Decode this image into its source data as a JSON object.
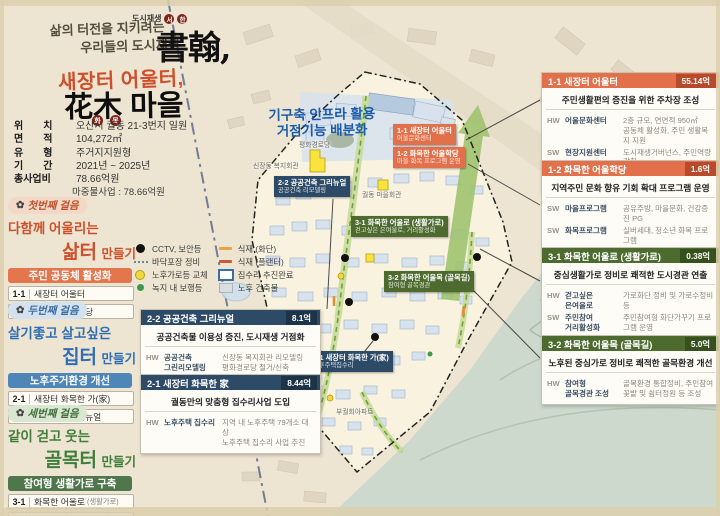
{
  "accents": {
    "orange": "#e2714b",
    "navy": "#2d4a66",
    "green": "#4d6b2f",
    "blue_banner": "#4f86b8",
    "note_blue": "#1b5caa"
  },
  "icons": {
    "flower": "✿"
  },
  "poster": {
    "slogan1": "삶의 터전을 지키려는",
    "slogan2": "우리들의 도시재생",
    "brand_prefix": "도시재생",
    "brand_circle1": "서",
    "brand_circle2": "한",
    "brand_hanja": "書翰,",
    "title_line1": "새장터 어울터,",
    "title_line2": "花木 마을",
    "title_circle1": "화",
    "title_circle2": "목"
  },
  "info": {
    "rows": [
      {
        "label": "위　　치",
        "value": "오산시 궐동 21-3번지 일원"
      },
      {
        "label": "면　　적",
        "value": "104,272㎡"
      },
      {
        "label": "유　　형",
        "value": "주거지지원형"
      },
      {
        "label": "기　　간",
        "value": "2021년 ~ 2025년"
      },
      {
        "label": "총사업비",
        "value": "78.66억원"
      }
    ],
    "sub_value": "마중물사업 : 78.66억원"
  },
  "steps": [
    {
      "badge": "첫번째 걸음",
      "line1": "다함께 어울리는",
      "word": "삶터",
      "suffix": "만들기",
      "banner": "주민 공동체 활성화",
      "items": [
        {
          "no": "1-1",
          "label": "새장터 어울터",
          "note": ""
        },
        {
          "no": "1-2",
          "label": "화목한 어울학당",
          "note": ""
        }
      ]
    },
    {
      "badge": "두번째 걸음",
      "line1": "살기좋고 살고싶은",
      "word": "집터",
      "suffix": "만들기",
      "banner": "노후주거환경 개선",
      "items": [
        {
          "no": "2-1",
          "label": "새장터 화목한 가(家)",
          "note": ""
        },
        {
          "no": "2-2",
          "label": "공공건축 그리뉴얼",
          "note": ""
        }
      ]
    },
    {
      "badge": "세번째 걸음",
      "line1": "같이 걷고 웃는",
      "word": "골목터",
      "suffix": "만들기",
      "banner": "참여형 생활가로 구축",
      "items": [
        {
          "no": "3-1",
          "label": "화목한 어울로",
          "note": "(생활가로)"
        },
        {
          "no": "3-2",
          "label": "화목한 어울목",
          "note": "(골목길)"
        }
      ]
    }
  ],
  "legend": {
    "col1": [
      {
        "icon": "cctv-icon",
        "label": "CCTV, 보안등"
      },
      {
        "icon": "paving-dots-icon",
        "label": "바닥포장 정비"
      },
      {
        "icon": "streetlamp-dot-icon",
        "label": "노후가로등 교체"
      },
      {
        "icon": "walklight-dot-icon",
        "label": "녹지 내 보행등"
      }
    ],
    "col2": [
      {
        "icon": "planting-flowerbed-line-icon",
        "label": "식재 (화단)"
      },
      {
        "icon": "planting-planter-line-icon",
        "label": "식재 (플랜터)"
      },
      {
        "icon": "repair-done-rect-icon",
        "label": "집수리 추진완료"
      },
      {
        "icon": "old-building-rect-icon",
        "label": "노후 건축물"
      }
    ]
  },
  "map": {
    "note": "기구축 인프라 활용\n거점기능 배분화",
    "landmark1": "평화경로당",
    "landmark2": "신장동 복지회관",
    "landmark3": "궐동 마을회관",
    "landmark4": "부궐회아파트",
    "tags": [
      {
        "title": "1-1 새장터 어울터",
        "sub": "어울문화센터"
      },
      {
        "title": "1-2 화목한 어울학당",
        "sub": "마을·화목 프로그램 운영"
      },
      {
        "title": "2-2 공공건축 그리뉴얼",
        "sub": "공공건축 리모델링"
      },
      {
        "title": "2-1 새장터 화목한 가(家)",
        "sub": "노후주택집수리"
      },
      {
        "title": "3-1 화목한 어울로 (생활가로)",
        "sub": "걷고싶은 은여울로, 거리활성화"
      },
      {
        "title": "3-2 화목한 어울목 (골목길)",
        "sub": "참여형 골목경관"
      }
    ]
  },
  "boxes": [
    {
      "title": "1-1 새장터 어울터",
      "budget": "55.14억",
      "subtitle": "주민생활편의 증진을 위한 주차장 조성",
      "rows": [
        {
          "tag": "HW",
          "name": "어울문화센터",
          "desc": "2층 규모, 연면적 950㎡\n공동체 활성화, 주민 생활복지 지원"
        },
        {
          "tag": "SW",
          "name": "현장지원센터",
          "desc": "도시재생거버넌스, 주민역량강화\n주민공모사업, 마을관리협동조합"
        }
      ]
    },
    {
      "title": "1-2 화목한 어울학당",
      "budget": "1.6억",
      "subtitle": "지역주민 문화 향유 기회 확대 프로그램 운영",
      "rows": [
        {
          "tag": "SW",
          "name": "마을프로그램",
          "desc": "공유주방, 마을문화, 건강증진 PG"
        },
        {
          "tag": "SW",
          "name": "화목프로그램",
          "desc": "실버세대, 청소년 화목 프로그램"
        }
      ]
    },
    {
      "title": "3-1 화목한 어울로 (생활가로)",
      "budget": "0.38억",
      "subtitle": "중심생활가로 정비로 쾌적한 도시경관 연출",
      "rows": [
        {
          "tag": "HW",
          "name": "걷고싶은\n은여울로",
          "desc": "가로화단 정비 및 가로수정비 등"
        },
        {
          "tag": "SW",
          "name": "주민참여\n거리활성화",
          "desc": "주민참여형 화단가꾸기 프로그램 운영"
        }
      ]
    },
    {
      "title": "3-2 화목한 어울목 (골목길)",
      "budget": "5.0억",
      "subtitle": "노후된 중심가로 정비로 쾌적한 골목환경 개선",
      "rows": [
        {
          "tag": "HW",
          "name": "참여형\n골목경관 조성",
          "desc": "골목환경 통합정비, 주민참여\n꽃밭 및 쉼터정원 등 조성"
        }
      ]
    },
    {
      "title": "2-2 공공건축 그리뉴얼",
      "budget": "8.1억",
      "subtitle": "공공건축물 이용성 증진, 도시재생 거점화",
      "rows": [
        {
          "tag": "HW",
          "name": "공공건축\n그린리모델링",
          "desc": "신장동 복지회관 리모델링\n평화경로당 철거/신축"
        }
      ]
    },
    {
      "title": "2-1 새장터 화목한 家",
      "budget": "8.44억",
      "subtitle": "궐동만의 맞춤형 집수리사업 도입",
      "rows": [
        {
          "tag": "HW",
          "name": "노후주택 집수리",
          "desc": "지역 내 노후주택 79개소 대상\n노후주택 집수리 사업 추진"
        }
      ]
    }
  ]
}
